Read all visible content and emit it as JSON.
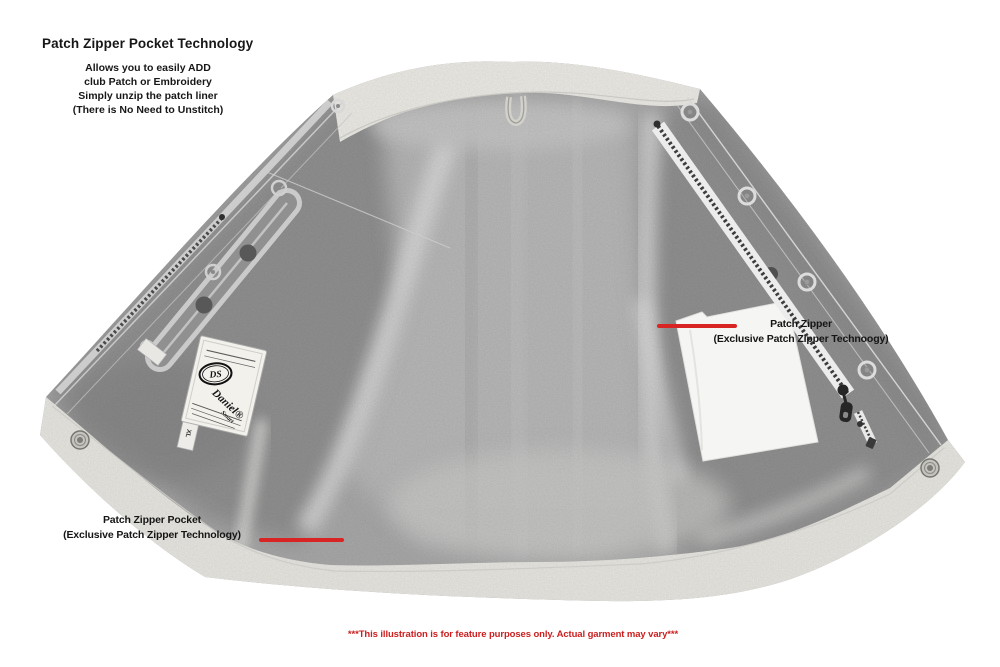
{
  "header": {
    "title": "Patch Zipper Pocket Technology",
    "subtitle_lines": [
      "Allows you to easily ADD",
      "club Patch or Embroidery",
      "Simply unzip the patch liner",
      "(There is No Need to Unstitch)"
    ]
  },
  "callouts": {
    "patch_zipper": {
      "title": "Patch Zipper",
      "subtitle": "(Exclusive Patch Zipper Technoogy)"
    },
    "patch_zipper_pocket": {
      "title": "Patch Zipper Pocket",
      "subtitle": "(Exclusive Patch Zipper Technology)"
    }
  },
  "disclaimer": "***This illustration is for feature purposes only. Actual garment may vary***",
  "garment_label": {
    "logo": "DS",
    "brand": "Daniel®",
    "brand_sub": "Smart",
    "size": "XL"
  },
  "colors": {
    "pointer_red": "#d92424",
    "disclaimer_red": "#cc1f1f",
    "fabric_gray": "#a8a8a8",
    "trim_white": "#e7e6e1"
  }
}
